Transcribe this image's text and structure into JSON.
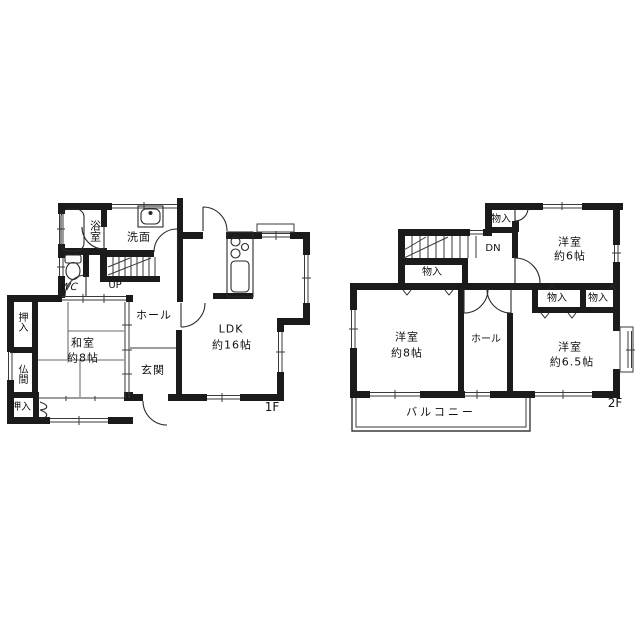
{
  "floor1": {
    "floor_label": "1F",
    "rooms": {
      "bath": "浴室",
      "washroom": "洗面",
      "wc": "WC",
      "stairs_up": "UP",
      "hall": "ホール",
      "entrance": "玄関",
      "ldk_name": "LDK",
      "ldk_size": "約16帖",
      "japanese_room_name": "和室",
      "japanese_room_size": "約8帖",
      "closet_upper": "押入",
      "altar_room": "仏間",
      "closet_lower": "押入"
    }
  },
  "floor2": {
    "floor_label": "2F",
    "rooms": {
      "stairs_down": "DN",
      "closet_top": "物入",
      "bedroom6_name": "洋室",
      "bedroom6_size": "約6帖",
      "closet_stairs": "物入",
      "bedroom8_name": "洋室",
      "bedroom8_size": "約8帖",
      "hall": "ホール",
      "closet_left": "物入",
      "closet_right": "物入",
      "bedroom65_name": "洋室",
      "bedroom65_size": "約6.5帖",
      "balcony": "バルコニー"
    }
  },
  "colors": {
    "wall": "#1b1b1b",
    "thin_line": "#3a3a3a",
    "text": "#111111",
    "background": "#ffffff"
  }
}
